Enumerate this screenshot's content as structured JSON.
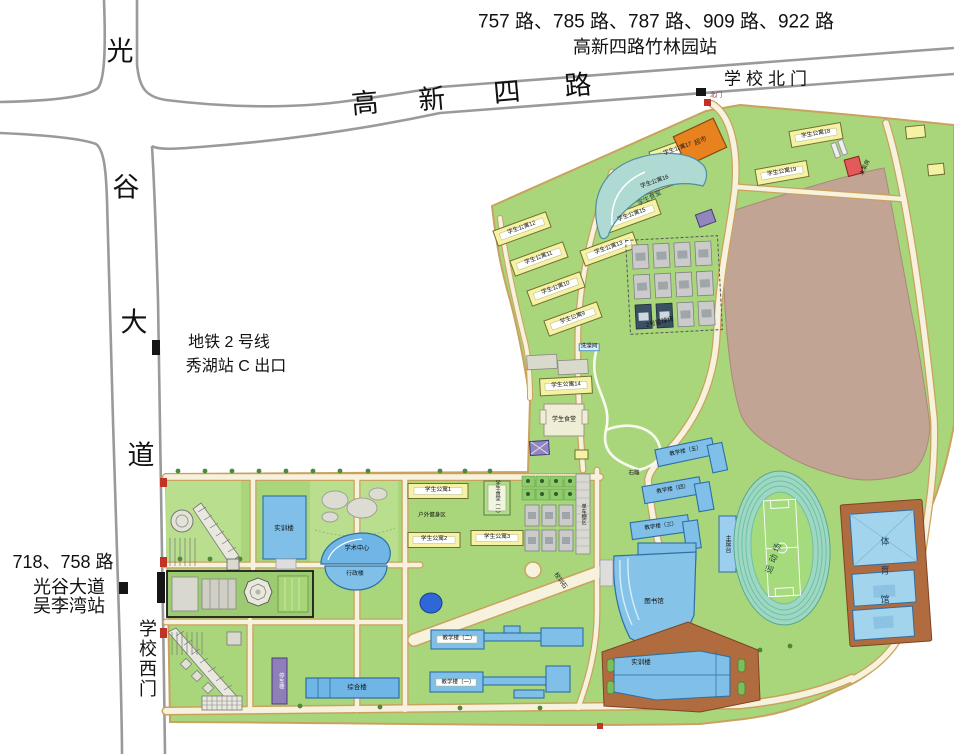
{
  "colors": {
    "campus_green": "#A9D67B",
    "lawn_light": "#B9DF8E",
    "road_cream": "#F7F2DD",
    "road_edge_tan": "#C9A25E",
    "offsite_road_gray": "#9A9A9A",
    "undeveloped_brown": "#C2A494",
    "dorm_yellow": "#F6F2A4",
    "building_blue": "#7FBFE8",
    "canteen_cyan": "#AFDAD3",
    "market_orange": "#E8821F",
    "track_teal": "#9ED8C2",
    "gym_brown": "#B06B3F",
    "purple_building": "#9187BE",
    "pump_red": "#E25A5A",
    "water_blue": "#2F67D6",
    "court_gray": "#CBCBCB"
  },
  "offsite": {
    "bus_north_line1": "757 路、785 路、787 路、909 路、922 路",
    "bus_north_line2": "高新四路竹林园站",
    "north_gate": "学校北门",
    "metro_line1": "地铁 2 号线",
    "metro_line2": "秀湖站 C 出口",
    "bus_west_line1": "718、758 路",
    "bus_west_line2": "光谷大道",
    "bus_west_line3": "吴李湾站",
    "west_gate": "学校西门",
    "road_h_c1": "高",
    "road_h_c2": "新",
    "road_h_c3": "四",
    "road_h_c4": "路",
    "road_v_c1": "光",
    "road_v_c2": "谷",
    "road_v_c3": "大",
    "road_v_c4": "道"
  },
  "campus": {
    "north_gate_small": "北门",
    "supermarket": "超市",
    "canteen_north": "学生食堂",
    "canteen_mid": "学生食堂",
    "canteen_1": "学生食堂（一）",
    "bath": "洗澡间",
    "basketball_2": "2号篮球场",
    "pump_house": "水泵房",
    "teach_5": "教学楼（五）",
    "teach_4": "教学楼（四）",
    "teach_3": "教学楼（三）",
    "teach_2": "教学楼（二）",
    "teach_1": "教学楼（一）",
    "rostrum": "主席台",
    "sports_field": "运动场",
    "gymnasium": "体育馆",
    "library": "图书馆",
    "training_south": "实训楼",
    "training_west": "实训楼",
    "complex_building": "综合楼",
    "parking_building": "停车楼",
    "academic_center": "学术中心",
    "admin_building": "行政楼",
    "fitness_area": "户外健身区",
    "bike_shed": "单车棚区",
    "motto_stone": "校训石",
    "sculpture": "石雕",
    "dorm_w1": "学生公寓12",
    "dorm_w2": "学生公寓11",
    "dorm_w3": "学生公寓10",
    "dorm_w4": "学生公寓9",
    "dorm_e1": "学生公寓17",
    "dorm_e2": "学生公寓16",
    "dorm_e3": "学生公寓15",
    "dorm_e4": "学生公寓13",
    "dorm_f1": "学生公寓18",
    "dorm_f2": "学生公寓19",
    "dorm_m1": "学生公寓14",
    "dorm_s1": "学生公寓1",
    "dorm_s2": "学生公寓2",
    "dorm_s3": "学生公寓3"
  }
}
